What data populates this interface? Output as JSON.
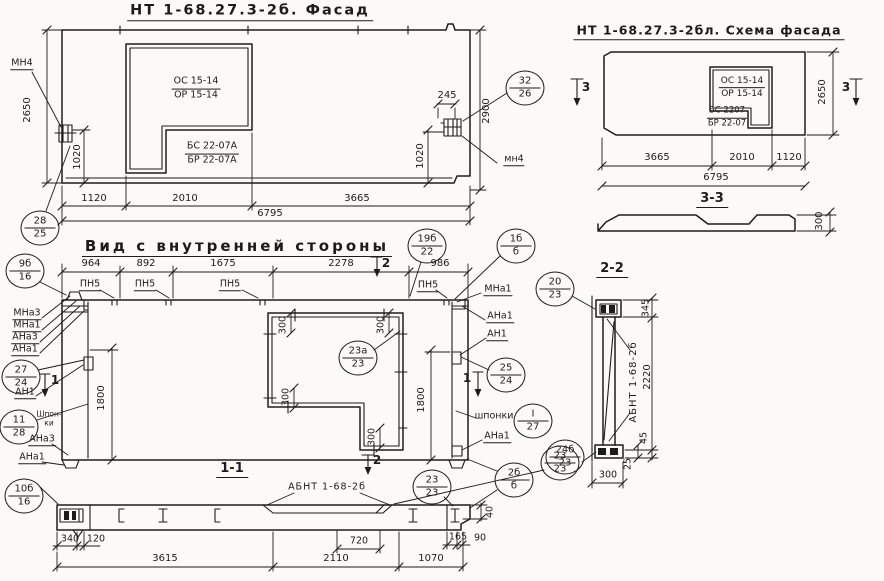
{
  "titles": {
    "facade": "НТ 1-68.27.3-2б. Фасад",
    "schema": "НТ 1-68.27.3-2бл. Схема фасада",
    "inner": "Вид с внутренней стороны",
    "s11": "1-1",
    "s22": "2-2",
    "s33": "3-3"
  },
  "labels": {
    "abnt": "АБНТ 1-68-2б",
    "os": "ОС 15-14",
    "or": "ОР 15-14",
    "bs_a": "БС 22-07А",
    "br_a": "БР 22-07А",
    "bs": "БС 2207",
    "br": "БР 22-07",
    "mn4_upper": "МН4",
    "mn4_lower": "мн4",
    "pn5": "ПН5",
    "mna3": "МНа3",
    "mna1": "МНа1",
    "ana3": "АНа3",
    "ana1": "АНа1",
    "an1": "АН1",
    "shponki": "шпонки",
    "shpon_hyph": "Шпон-",
    "ki": "ки"
  },
  "sections": {
    "s1": "1",
    "s2": "2",
    "s3": "3"
  },
  "dims": {
    "d2650": "2650",
    "d2900": "2900",
    "d1020": "1020",
    "d1120": "1120",
    "d2010": "2010",
    "d3665": "3665",
    "d6795": "6795",
    "d245": "245",
    "d964": "964",
    "d892": "892",
    "d1675": "1675",
    "d2278": "2278",
    "d986": "986",
    "d1800": "1800",
    "d300": "300",
    "d340": "340",
    "d120": "120",
    "d3615": "3615",
    "d2110": "2110",
    "d720": "720",
    "d1070": "1070",
    "d165": "165",
    "d90": "90",
    "d40": "40",
    "d345": "345",
    "d2220": "2220",
    "d45": "45",
    "d25": "25"
  },
  "callouts": {
    "c28_25": {
      "top": "28",
      "bottom": "25"
    },
    "c32_26": {
      "top": "32",
      "bottom": "26"
    },
    "c9b_16": {
      "top": "9б",
      "bottom": "16"
    },
    "c19b_22": {
      "top": "19б",
      "bottom": "22"
    },
    "c1b_b": {
      "top": "1б",
      "bottom": "б"
    },
    "c27_24": {
      "top": "27",
      "bottom": "24"
    },
    "c11_28": {
      "top": "11",
      "bottom": "28"
    },
    "c25_24": {
      "top": "25",
      "bottom": "24"
    },
    "cI_27": {
      "top": "I",
      "bottom": "27"
    },
    "c23a_23": {
      "top": "23а",
      "bottom": "23"
    },
    "c2b_b": {
      "top": "2б",
      "bottom": "б"
    },
    "c23_23": {
      "top": "23",
      "bottom": "23"
    },
    "c10b_16": {
      "top": "10б",
      "bottom": "16"
    },
    "c20_23": {
      "top": "20",
      "bottom": "23"
    },
    "c24b_23": {
      "top": "24б",
      "bottom": "23"
    }
  }
}
